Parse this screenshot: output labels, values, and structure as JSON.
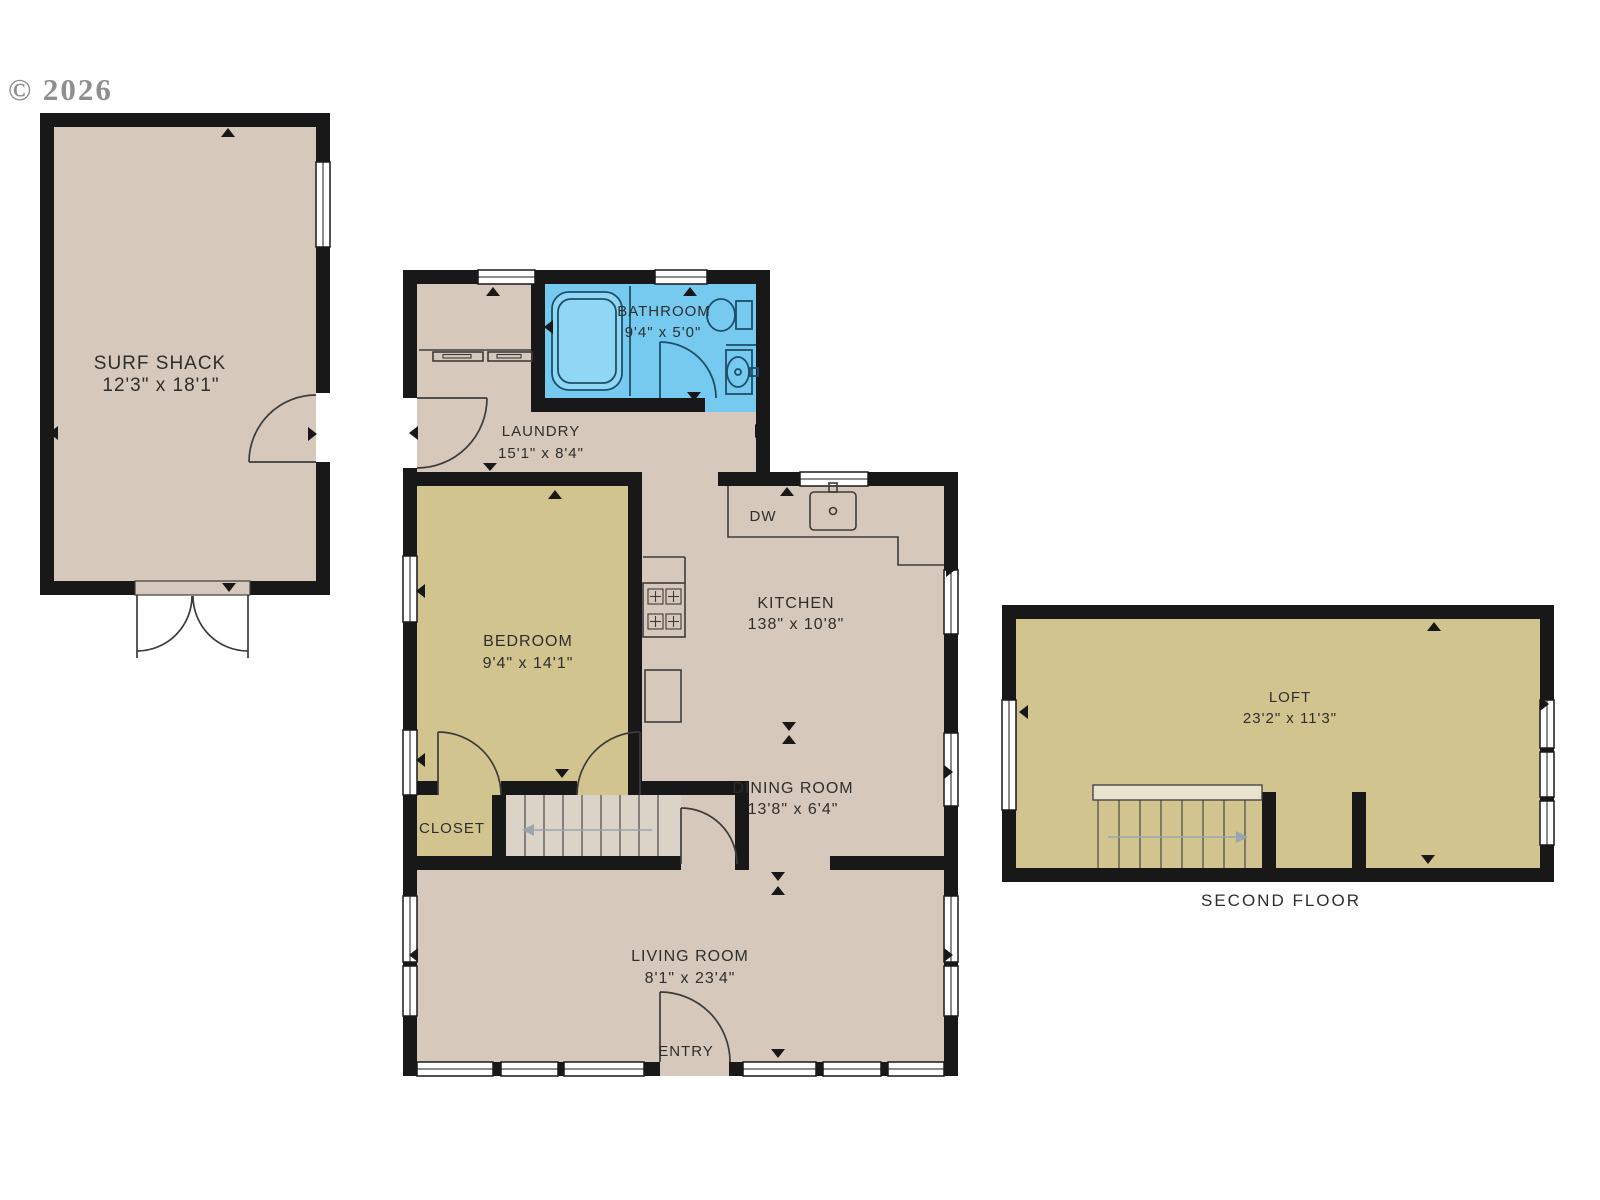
{
  "watermark": "© 2026",
  "rooms": {
    "surf_shack": {
      "label": "SURF SHACK",
      "dims": "12'3\" x 18'1\""
    },
    "bathroom": {
      "label": "BATHROOM",
      "dims": "9'4\" x 5'0\""
    },
    "laundry": {
      "label": "LAUNDRY",
      "dims": "15'1\" x 8'4\""
    },
    "bedroom": {
      "label": "BEDROOM",
      "dims": "9'4\" x 14'1\""
    },
    "kitchen": {
      "label": "KITCHEN",
      "dims": "138\" x 10'8\""
    },
    "dining_room": {
      "label": "DINING ROOM",
      "dims": "13'8\" x 6'4\""
    },
    "closet": {
      "label": "CLOSET"
    },
    "living_room": {
      "label": "LIVING ROOM",
      "dims": "8'1\" x 23'4\""
    },
    "entry": {
      "label": "ENTRY"
    },
    "dishwasher": {
      "label": "DW"
    },
    "loft": {
      "label": "LOFT",
      "dims": "23'2\" x 11'3\""
    }
  },
  "captions": {
    "second_floor": "SECOND FLOOR"
  },
  "colors": {
    "background": "#ffffff",
    "wall": "#181818",
    "floor_tan": "#d6c8ba",
    "floor_olive": "#d2c48f",
    "floor_blue": "#76c9ef",
    "tub_fill": "#8fd7f5",
    "stair_fill": "#dcd3c8",
    "landing_fill": "#e9e2cf",
    "bath_line": "#1c4f69",
    "fixture_line": "#3c3c3c",
    "arrow": "#9aa5ad",
    "text": "#2e2e2e",
    "watermark_color": "#8f8f8f"
  }
}
